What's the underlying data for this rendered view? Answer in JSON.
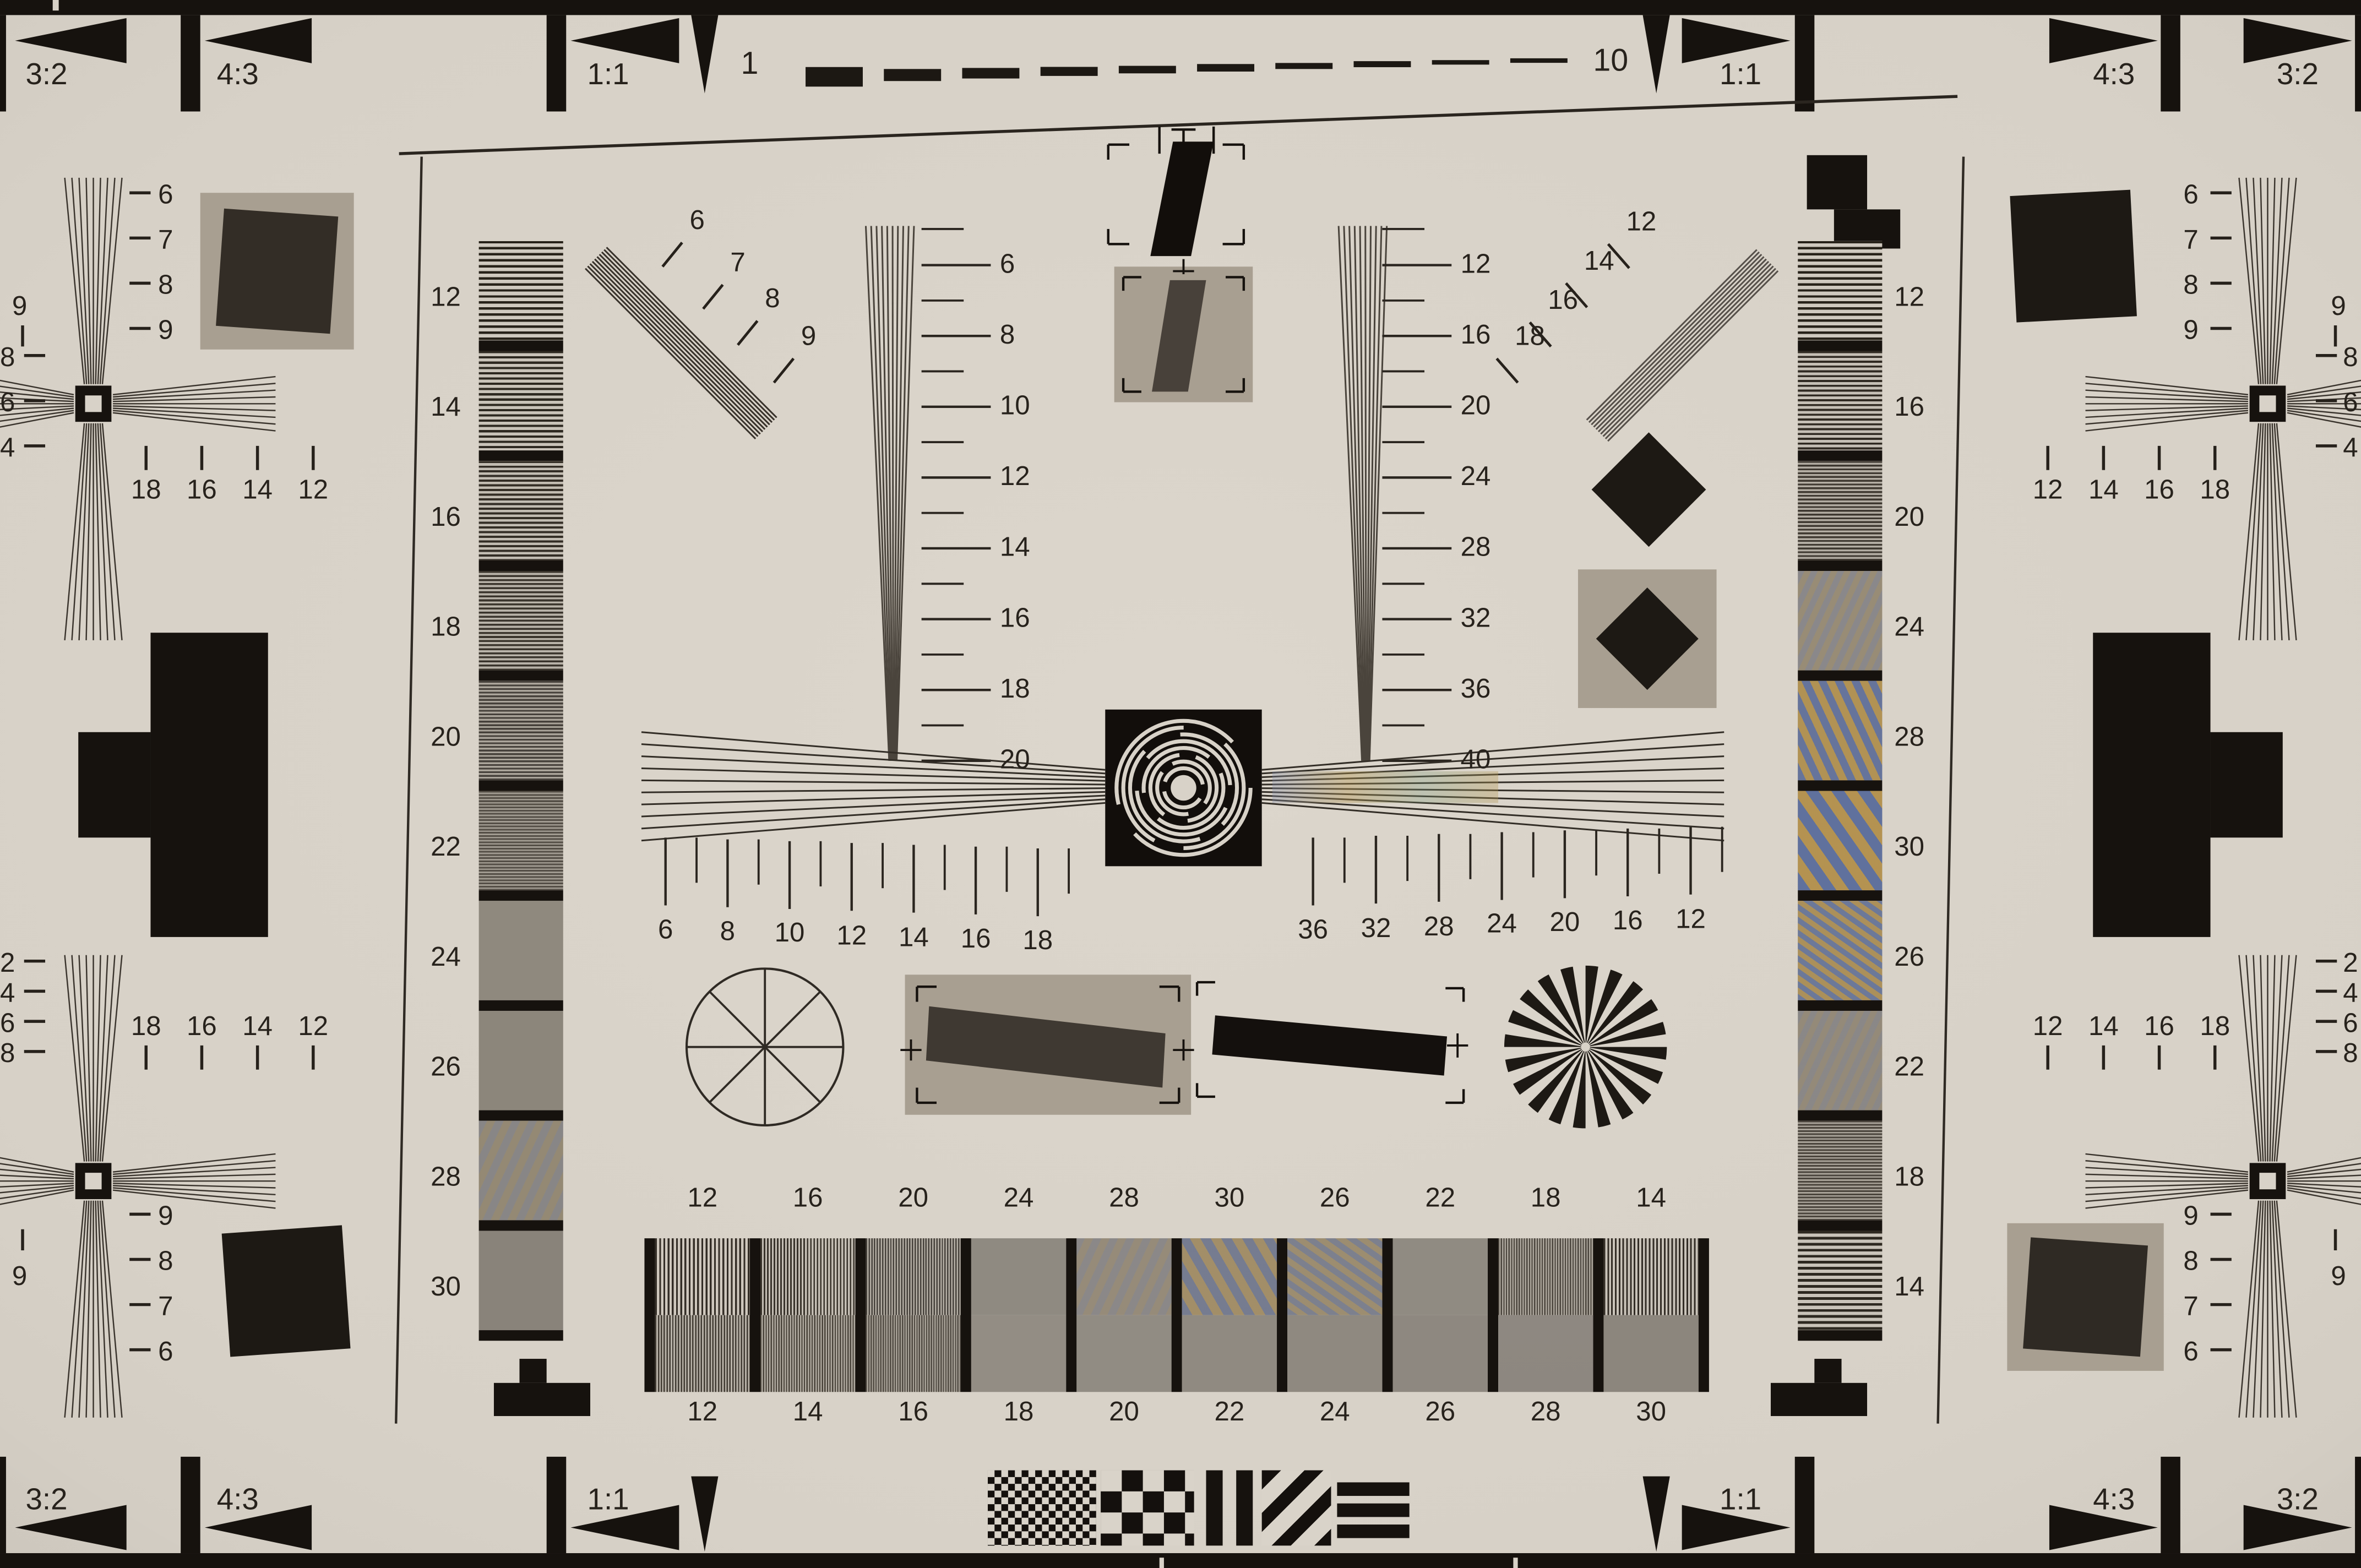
{
  "corner_labels": [
    "3:2",
    "4:3",
    "1:1"
  ],
  "ruler": {
    "start": "1",
    "end": "10"
  },
  "scales": {
    "left_vertical": {
      "labels": [
        "6",
        "8",
        "10",
        "12",
        "14",
        "16",
        "18",
        "20"
      ]
    },
    "right_vertical": {
      "labels": [
        "12",
        "16",
        "20",
        "24",
        "28",
        "32",
        "36",
        "40"
      ]
    },
    "center_left": {
      "labels": [
        "6",
        "8",
        "10",
        "12",
        "14",
        "16",
        "18"
      ]
    },
    "center_right": {
      "labels": [
        "36",
        "32",
        "28",
        "24",
        "20",
        "16",
        "12"
      ]
    }
  },
  "strips": {
    "left": {
      "labels": [
        "12",
        "14",
        "16",
        "18",
        "20",
        "22",
        "24",
        "26",
        "28",
        "30"
      ]
    },
    "right": {
      "labels": [
        "12",
        "16",
        "20",
        "24",
        "28",
        "30",
        "26",
        "22",
        "18",
        "14"
      ]
    }
  },
  "bottom_bars": {
    "top_labels": [
      "12",
      "16",
      "20",
      "24",
      "28",
      "30",
      "26",
      "22",
      "18",
      "14"
    ],
    "bottom_labels": [
      "12",
      "14",
      "16",
      "18",
      "20",
      "22",
      "24",
      "26",
      "28",
      "30"
    ]
  },
  "diag_fans": {
    "left": {
      "labels": [
        "6",
        "7",
        "8",
        "9"
      ]
    },
    "right": {
      "labels": [
        "12",
        "14",
        "16",
        "18"
      ]
    }
  },
  "corner_clusters": {
    "tl": {
      "col": [
        "6",
        "7",
        "8",
        "9"
      ],
      "lone": "9",
      "row": [
        "18",
        "16",
        "14",
        "12"
      ],
      "edge": [
        "8",
        "6",
        "4"
      ]
    },
    "tr": {
      "col": [
        "6",
        "7",
        "8",
        "9"
      ],
      "lone": "9",
      "row": [
        "12",
        "14",
        "16",
        "18"
      ],
      "edge": [
        "8",
        "6",
        "4"
      ]
    },
    "bl": {
      "col": [
        "9",
        "8",
        "7",
        "6"
      ],
      "lone": "9",
      "row": [
        "18",
        "16",
        "14",
        "12"
      ],
      "edge": [
        "2",
        "4",
        "6",
        "8"
      ]
    },
    "br": {
      "col": [
        "9",
        "8",
        "7",
        "6"
      ],
      "lone": "9",
      "row": [
        "12",
        "14",
        "16",
        "18"
      ],
      "edge": [
        "2",
        "4",
        "6",
        "8"
      ]
    }
  },
  "colors": {
    "paper": "#d8d2c8",
    "ink": "#16120e",
    "gray_target_bg": "#a89f91",
    "dark_bar": "#48413a",
    "dark_square": "#332d26",
    "fan_line": "#3a342d",
    "moire_blue": "#7f89a3",
    "moire_gold": "#b0955c"
  }
}
